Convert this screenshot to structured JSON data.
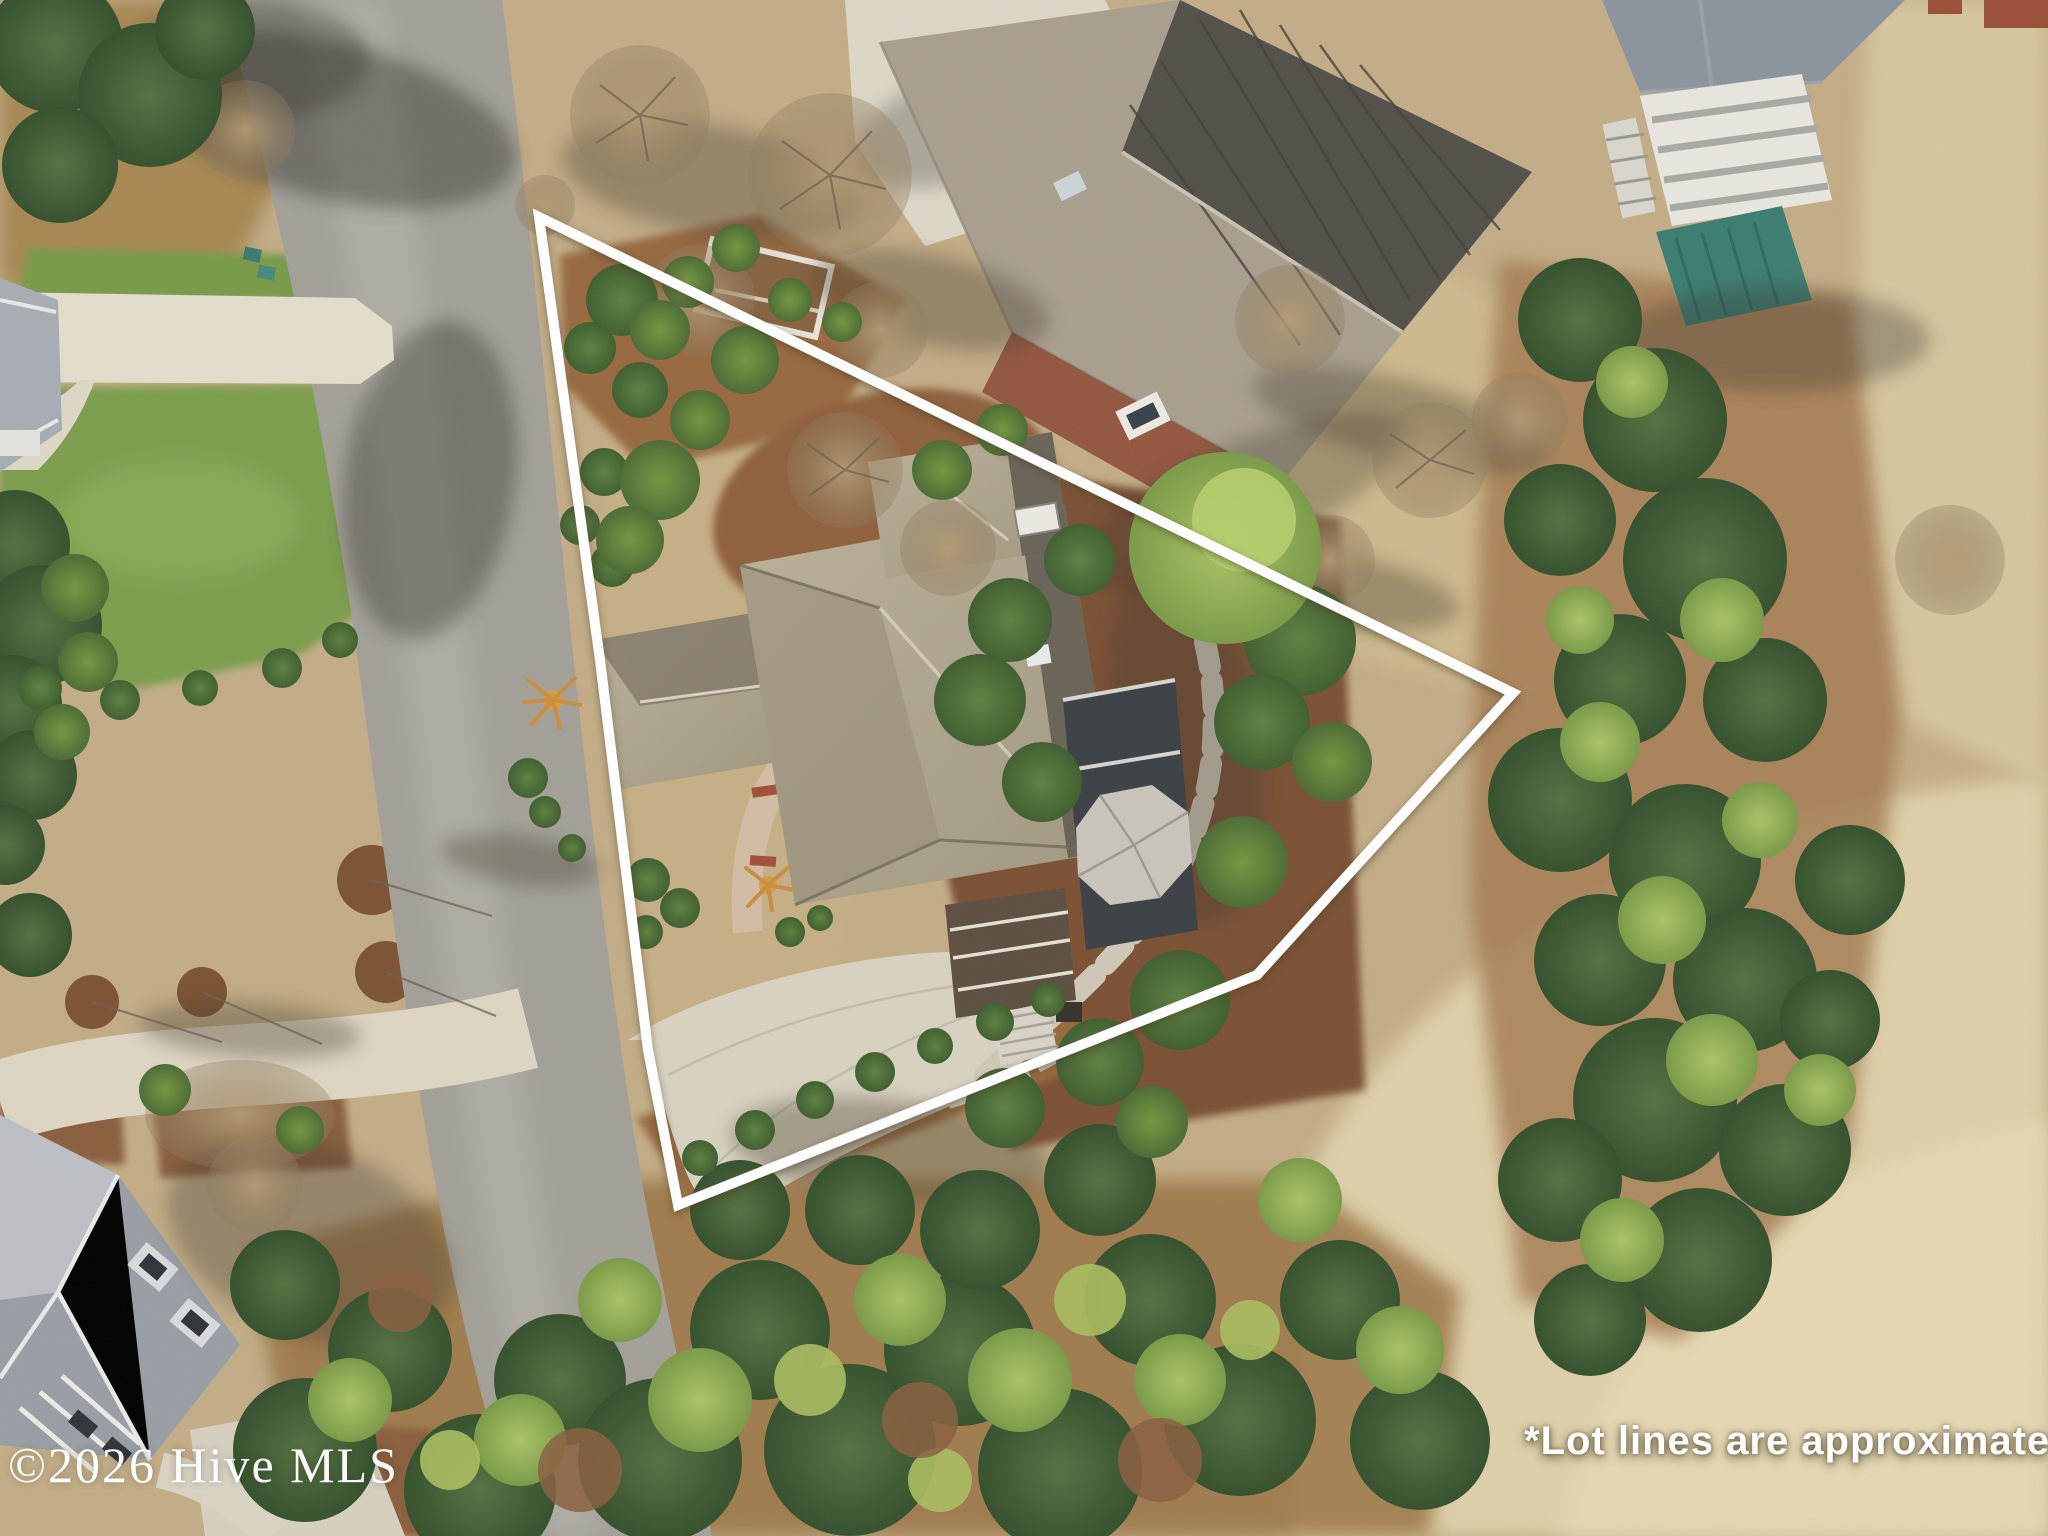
{
  "image": {
    "kind": "aerial-drone-real-estate-photo",
    "width_px": 2048,
    "height_px": 1536
  },
  "overlays": {
    "watermark": {
      "text": "©2026 Hive MLS",
      "color": "#ffffff",
      "position": "bottom-left"
    },
    "disclaimer": {
      "text": "*Lot lines are approximate",
      "color": "#ffffff",
      "position": "bottom-right"
    }
  },
  "lot_line": {
    "color": "#ffffff",
    "stroke_width": "10",
    "points": "539,217 1513,693 1257,975 678,1205 648,1050 600,660"
  },
  "scene": {
    "description": "Overhead winter aerial of a triangular corner lot outlined in white: large taupe-shingle hip-roof home with screened porch, curved concrete driveway, mulch beds and shrubs; curving street on the west, neighboring homes north, northeast and southwest, pine woods east, golf fairway and putting green at the southeast corner.",
    "palette": {
      "asphalt_road": "#a3a098",
      "concrete": "#dbd5c4",
      "dead_grass": "#c3ad87",
      "fairway": "#ddcfa8",
      "green_lawn": "#7d9e4d",
      "mulch": "#96663e",
      "pine_dark": "#42603a",
      "pine_light": "#8fae57",
      "subject_roof": "#b2a88f",
      "screened_porch": "#3c4145",
      "gazebo_roof": "#c9c5ba",
      "neighbor_dark_roof": "#53504a",
      "brick": "#9a563e",
      "teal_porch_roof": "#3c7d72",
      "blue_gray_roof": "#8b949d",
      "putting_green": "#aaa968"
    }
  }
}
